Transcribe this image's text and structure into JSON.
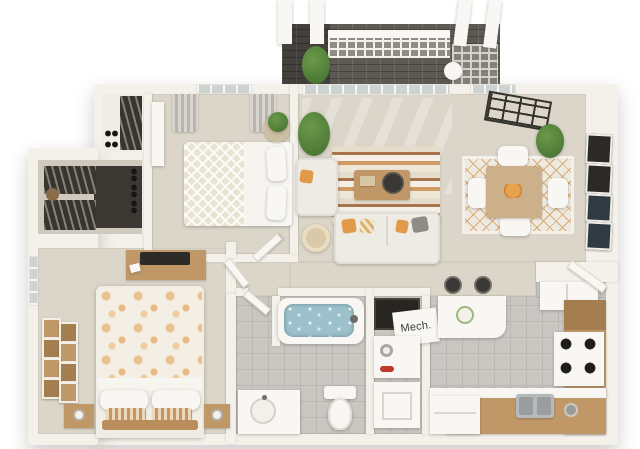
{
  "image_type": "3d-rendered-apartment-floor-plan",
  "labels": {
    "mech_room": "Mech."
  },
  "palette": {
    "bg": "#ffffff",
    "wall": "#f3f1ea",
    "floor": "#dbd6c9",
    "floorDark": "#cfcabd",
    "tile": "#c9c7c2",
    "tileLine": "#bab8b3",
    "deck": "#5d5a54",
    "latticeDark": "#8f8c84",
    "white": "#f8f7f3",
    "soft": "#edebe3",
    "glass": "#ccd3d0",
    "wood": "#c09868",
    "woodDark": "#a57e50",
    "green": "#4d7b37",
    "greenLight": "#6b9849",
    "orange": "#e09a4a",
    "dark": "#2c2a27",
    "navy": "#2f3a43",
    "water": "#9dc1cc",
    "steel": "#b6b9ba",
    "red": "#c0392b",
    "text": "#3b3b39"
  },
  "scene": {
    "balcony": {
      "items": [
        "wood-deck",
        "lattice-railing",
        "white-columns-x4",
        "potted-plant",
        "side-table"
      ]
    },
    "living_room": {
      "items": [
        "sliding-glass-door",
        "loveseat",
        "sofa-with-throw-pillows",
        "coffee-table-with-tray",
        "striped-area-rug",
        "floor-plant",
        "round-pouf"
      ]
    },
    "dining_area": {
      "items": [
        "square-wood-table",
        "white-chairs-x4",
        "diamond-pattern-rug",
        "orange-centerpiece",
        "wall-art-frames-x4",
        "tall-plant",
        "ceiling-lattice-decor"
      ]
    },
    "bedroom_2": {
      "items": [
        "bed-with-diamond-throw",
        "curtained-window",
        "plant-basket",
        "white-wardrobe",
        "reach-in-closet-with-shoes"
      ]
    },
    "walk_in_closet": {
      "items": [
        "hanging-clothes",
        "shoe-shelves",
        "storage-basket"
      ]
    },
    "master_bedroom": {
      "items": [
        "bed-with-floral-duvet",
        "striped-accent-pillows",
        "nightstands-x2",
        "table-lamps-x2",
        "dresser-with-tv",
        "window",
        "gallery-picture-frames-x8"
      ]
    },
    "hallway": {
      "items": [
        "interior-doors"
      ]
    },
    "bathroom": {
      "items": [
        "bathtub-with-water",
        "toilet",
        "vanity-with-round-sink",
        "tile-floor",
        "door"
      ]
    },
    "utility": {
      "items": [
        "mech-closet",
        "dark-storage-closet",
        "washer",
        "dryer"
      ]
    },
    "kitchen": {
      "items": [
        "breakfast-bar",
        "bar-stools-x2",
        "refrigerator",
        "range-with-4-burners",
        "double-sink",
        "dishwasher",
        "wood-cabinets",
        "entry-door",
        "tile-floor"
      ]
    }
  }
}
